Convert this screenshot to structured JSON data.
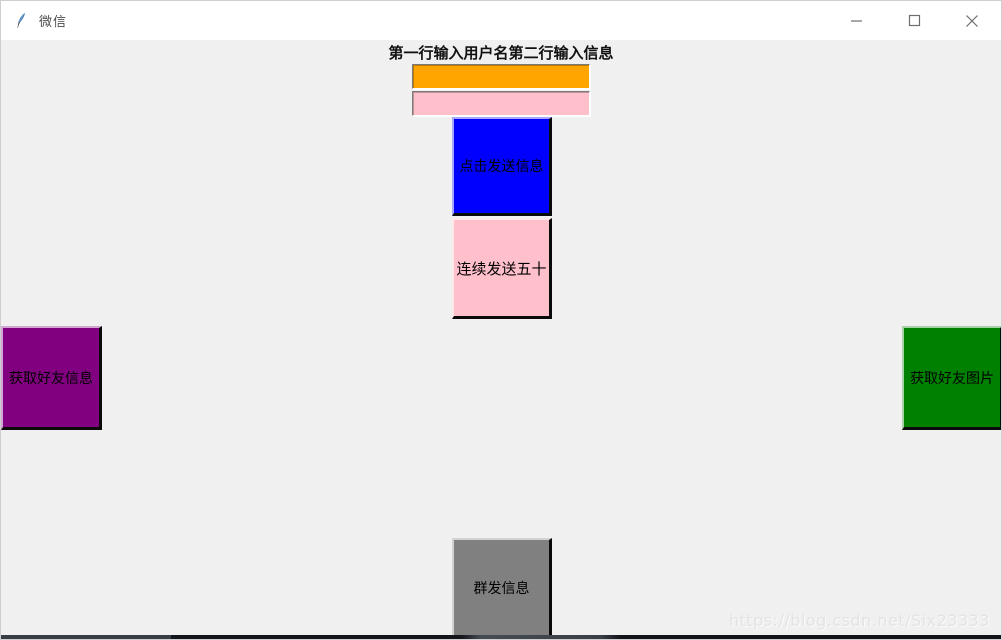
{
  "window": {
    "title": "微信",
    "controls": {
      "minimize_label": "minimize",
      "maximize_label": "maximize",
      "close_label": "close"
    }
  },
  "form": {
    "instruction_label": "第一行输入用户名第二行输入信息",
    "username_entry": {
      "value": "",
      "bg": "#ffa500"
    },
    "message_entry": {
      "value": "",
      "bg": "#ffc0cb"
    },
    "buttons": {
      "send": {
        "label": "点击发送信息",
        "bg": "#0000ff"
      },
      "send_fifty": {
        "label": "连续发送五十",
        "bg": "#ffc0cb"
      },
      "get_friend_info": {
        "label": "获取好友信息",
        "bg": "#800080"
      },
      "get_friend_images": {
        "label": "获取好友图片",
        "bg": "#008000"
      },
      "mass_send": {
        "label": "群发信息",
        "bg": "#808080"
      }
    }
  },
  "watermark": "https://blog.csdn.net/Six23333"
}
